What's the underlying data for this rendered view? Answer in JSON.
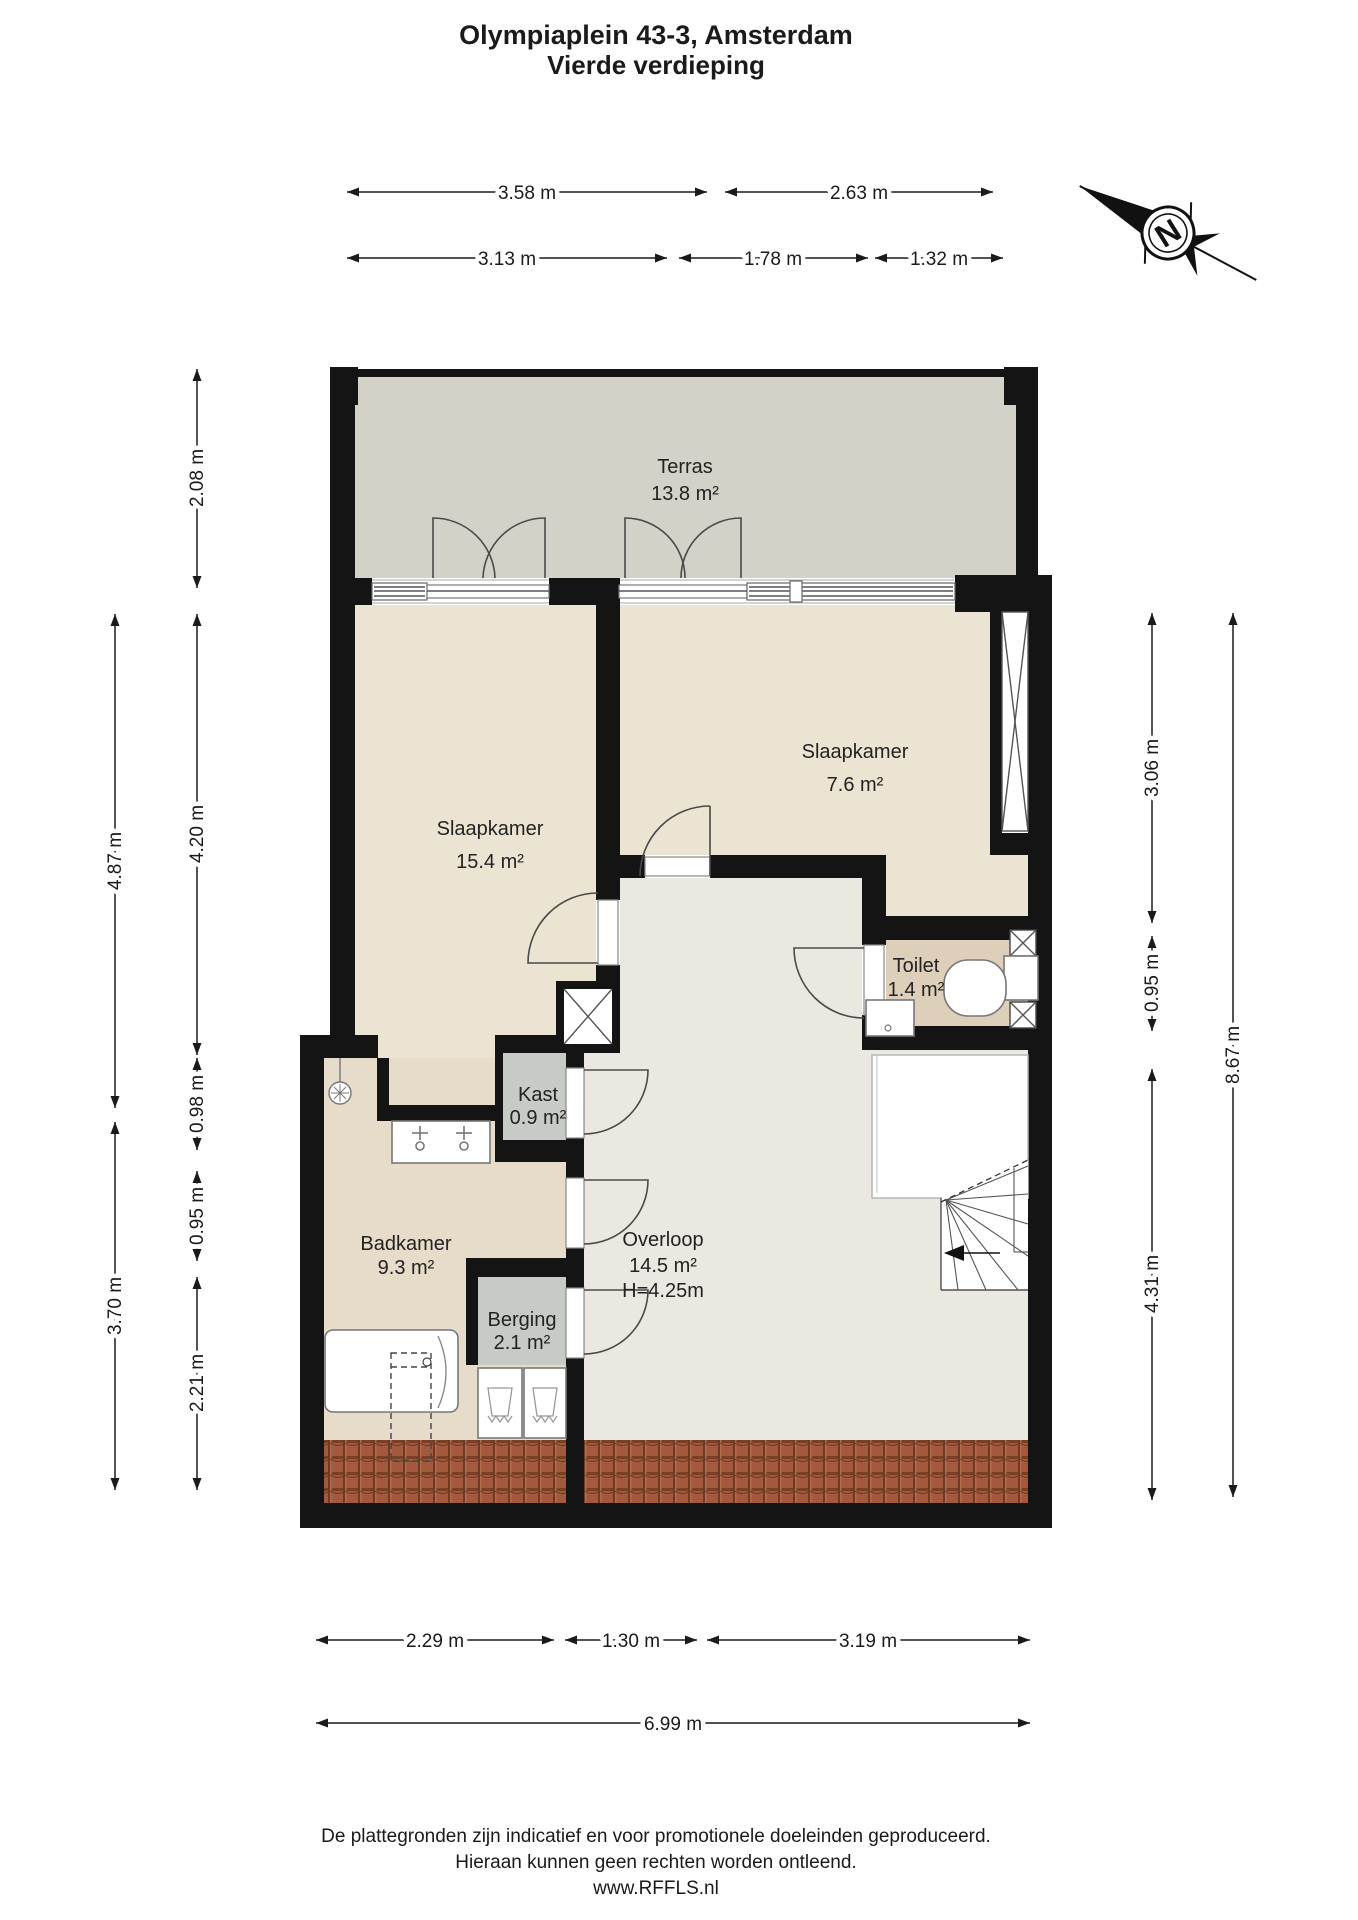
{
  "title": {
    "line1": "Olympiaplein 43-3, Amsterdam",
    "line2": "Vierde verdieping"
  },
  "compass": {
    "label": "N"
  },
  "rooms": {
    "terras": {
      "name": "Terras",
      "area": "13.8 m²"
    },
    "slaapkamer1": {
      "name": "Slaapkamer",
      "area": "15.4 m²"
    },
    "slaapkamer2": {
      "name": "Slaapkamer",
      "area": "7.6 m²"
    },
    "toilet": {
      "name": "Toilet",
      "area": "1.4 m²"
    },
    "kast": {
      "name": "Kast",
      "area": "0.9 m²"
    },
    "badkamer": {
      "name": "Badkamer",
      "area": "9.3 m²"
    },
    "berging": {
      "name": "Berging",
      "area": "2.1 m²"
    },
    "overloop": {
      "name": "Overloop",
      "area": "14.5 m²",
      "height": "H=4.25m"
    }
  },
  "dims": {
    "top1": [
      "3.58 m",
      "2.63 m"
    ],
    "top2": [
      "3.13 m",
      "1.78 m",
      "1.32 m"
    ],
    "left_outer": [
      "4.87 m",
      "3.70 m"
    ],
    "left_inner": [
      "2.08 m",
      "4.20 m",
      "0.98 m",
      "0.95 m",
      "2.21 m"
    ],
    "right_inner": [
      "3.06 m",
      "0.95 m",
      "4.31 m"
    ],
    "right_outer": [
      "8.67 m"
    ],
    "bottom1": [
      "2.29 m",
      "1.30 m",
      "3.19 m"
    ],
    "bottom2": [
      "6.99 m"
    ]
  },
  "footer": {
    "line1": "De plattegronden zijn indicatief en voor promotionele doeleinden geproduceerd.",
    "line2": "Hieraan kunnen geen rechten worden ontleend.",
    "line3": "www.RFFLS.nl"
  },
  "colors": {
    "wall": "#141414",
    "terras": "#d3d1c8",
    "bedroom": "#ece4d3",
    "hall": "#eae8e0",
    "toilet": "#decfba",
    "closet": "#c7cbc5",
    "bath": "#e7dbc9",
    "rooftile": "#a2593d"
  }
}
